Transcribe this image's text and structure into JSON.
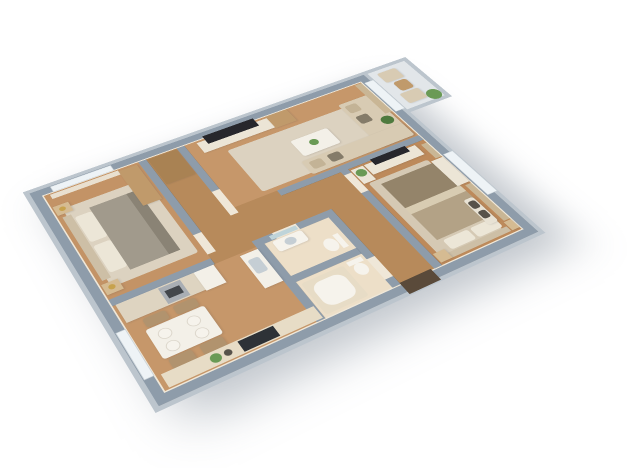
{
  "scene": {
    "type": "3d-floorplan-render",
    "view": "isometric-top-down",
    "background": "white",
    "apartment": {
      "rooms": [
        {
          "id": "living-room",
          "furniture": [
            "tv-media-console",
            "flat-tv",
            "tall-shelf-unit",
            "l-shaped-sofa",
            "throw-pillows",
            "coffee-table",
            "area-rug",
            "curtain",
            "potted-plant",
            "balcony-glass-door"
          ]
        },
        {
          "id": "master-bedroom",
          "furniture": [
            "double-bed",
            "pillows",
            "tv-console",
            "flat-tv",
            "planter-box",
            "area-rug",
            "nightstand-left",
            "nightstand-right",
            "bench",
            "dresser",
            "curtains",
            "window"
          ]
        },
        {
          "id": "bedroom-2",
          "furniture": [
            "double-bed",
            "pillows",
            "headboard",
            "nightstand-top",
            "nightstand-bottom",
            "gold-table-lamps",
            "wardrobe",
            "area-rug",
            "window-curtain"
          ]
        },
        {
          "id": "kitchen-dining",
          "furniture": [
            "cabinet-run",
            "oven",
            "fridge",
            "sink-counter",
            "dining-table",
            "four-plates",
            "four-chairs",
            "bottom-counter",
            "cooktop",
            "plant-decor"
          ]
        },
        {
          "id": "bathroom-1",
          "furniture": [
            "washbasin",
            "mirror",
            "toilet"
          ]
        },
        {
          "id": "bathroom-2",
          "furniture": [
            "bathtub",
            "toilet"
          ]
        },
        {
          "id": "hallway",
          "furniture": [
            "tall-wardrobe"
          ]
        },
        {
          "id": "entry",
          "furniture": [
            "front-door"
          ]
        },
        {
          "id": "balcony",
          "furniture": [
            "armchair-1",
            "armchair-2",
            "side-table",
            "potted-plant",
            "glass-railing"
          ]
        }
      ]
    },
    "colors": {
      "background": "#ffffff",
      "wall_top": "#8e9caa",
      "wall_face": "#bcc5cd",
      "wall_base": "#efe7d8",
      "floor_living": "#c6976a",
      "floor_hall": "#b78a5b",
      "floor_master": "#bd8a5b",
      "floor_bedroom2": "#c39366",
      "floor_kitchen": "#c6976a",
      "floor_bath": "#eddfc8",
      "floor_balcony": "#e2e6e9",
      "rug": "#dcd2c0",
      "rug_master": "#d5c9b4",
      "sofa": "#d8cbb3",
      "pillow": "#c3b396",
      "pillow_dark": "#847b69",
      "pillow_cream": "#ece6d7",
      "table_white": "#f3f0e8",
      "furniture_white": "#ece5d6",
      "bench_white": "#e8e2d4",
      "cushion_dark": "#57524a",
      "wood_light": "#d5bb92",
      "wood_mid": "#c09a6b",
      "wood_dark": "#a98253",
      "cabinet": "#ded4c1",
      "counter": "#e7dcc6",
      "steel": "#a9aeb4",
      "steel_dark": "#43474c",
      "tv_dark": "#27272c",
      "cooktop": "#2e3237",
      "duvet_gray": "#a19a8c",
      "duvet_gray_dark": "#8a8375",
      "blanket_taupe": "#b3a286",
      "blanket_taupe_dark": "#94846a",
      "sheet_cream": "#d8ccb2",
      "headboard": "#cdbfa6",
      "curtain": "#e9e0d0",
      "curtain_tan": "#c9b695",
      "glass": "#eef3f6",
      "frame": "#ccd4d9",
      "plant": "#6a9a55",
      "plant_dark": "#4e7a3e",
      "gold": "#c7a24d",
      "ceramic": "#f6f3ec",
      "mirror": "#bfd4d9",
      "door_dark": "#5a4a3a",
      "sink_gray": "#c5ced4",
      "chair_tan": "#b1936e"
    }
  }
}
